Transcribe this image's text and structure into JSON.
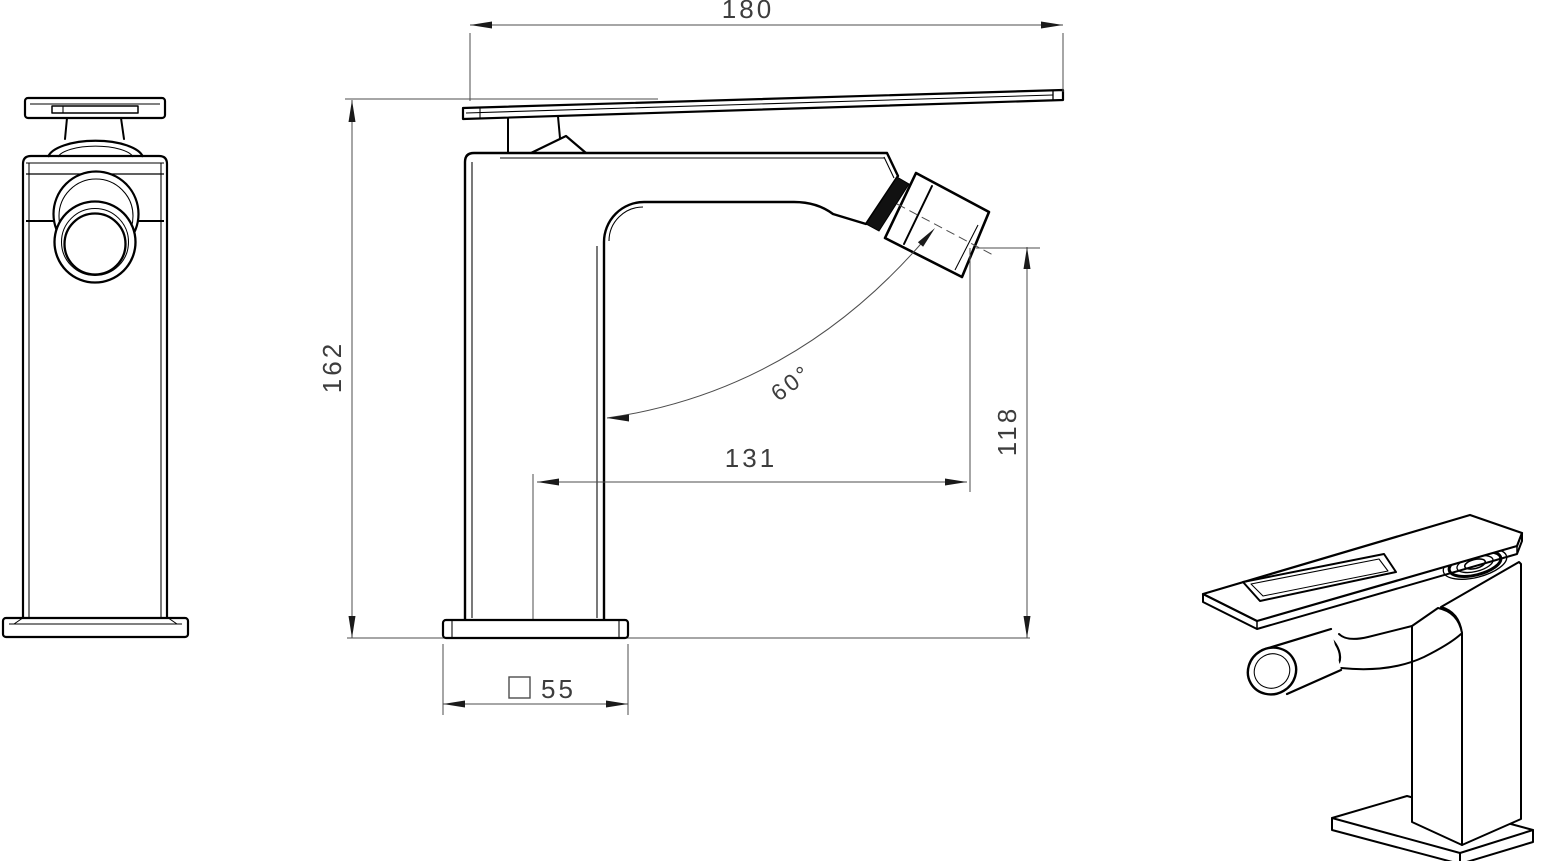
{
  "dimensions": {
    "handle_length": "180",
    "overall_height": "162",
    "spout_reach": "131",
    "outlet_height": "118",
    "spout_angle": "60°",
    "base_width": "55"
  },
  "colors": {
    "background": "#ffffff",
    "object_line": "#000000",
    "dimension_line": "#4d4d4d",
    "dimension_text": "#3d3d3d"
  }
}
